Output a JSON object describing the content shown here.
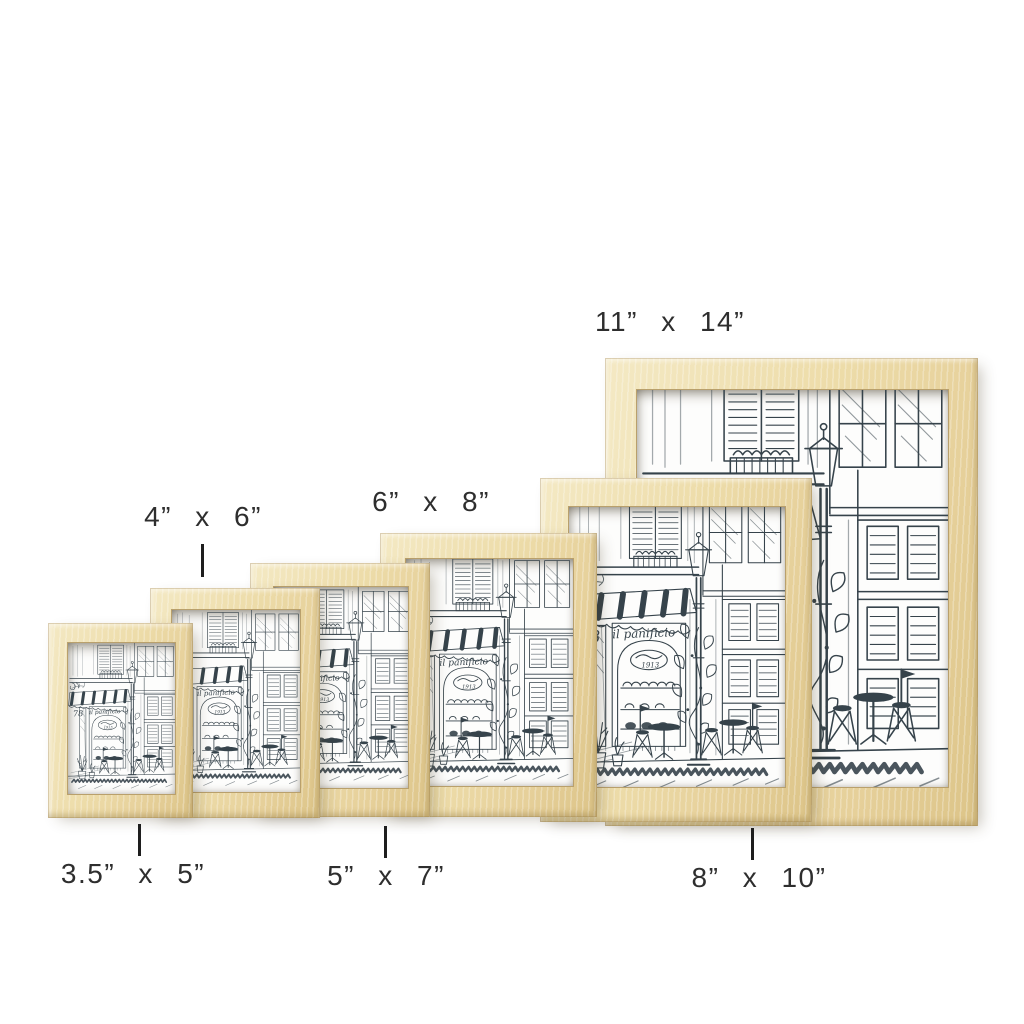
{
  "canvas": {
    "width": 1024,
    "height": 1024,
    "background": "#ffffff"
  },
  "colors": {
    "wood_light": "#f4e9c4",
    "wood_mid": "#eddca9",
    "wood_dark": "#dcc488",
    "sketch_ink": "#36434b",
    "paper": "#fdfdfc",
    "label_text": "#2e2e2e"
  },
  "artwork": {
    "subject": "cafe-storefront-sketch",
    "shop_sign": "il panificio",
    "street_number": "78",
    "oval_sign": "1913"
  },
  "frames": [
    {
      "id": "frame-3.5x5",
      "size": "3.5\" x 5\"",
      "label": "3.5” x 5”",
      "label_position": "below"
    },
    {
      "id": "frame-4x6",
      "size": "4\" x 6\"",
      "label": "4” x 6”",
      "label_position": "above"
    },
    {
      "id": "frame-5x7",
      "size": "5\" x 7\"",
      "label": "5” x 7”",
      "label_position": "below"
    },
    {
      "id": "frame-6x8",
      "size": "6\" x 8\"",
      "label": "6” x 8”",
      "label_position": "above"
    },
    {
      "id": "frame-8x10",
      "size": "8\" x 10\"",
      "label": "8” x 10”",
      "label_position": "below"
    },
    {
      "id": "frame-11x14",
      "size": "11\" x 14\"",
      "label": "11” x 14”",
      "label_position": "above"
    }
  ]
}
